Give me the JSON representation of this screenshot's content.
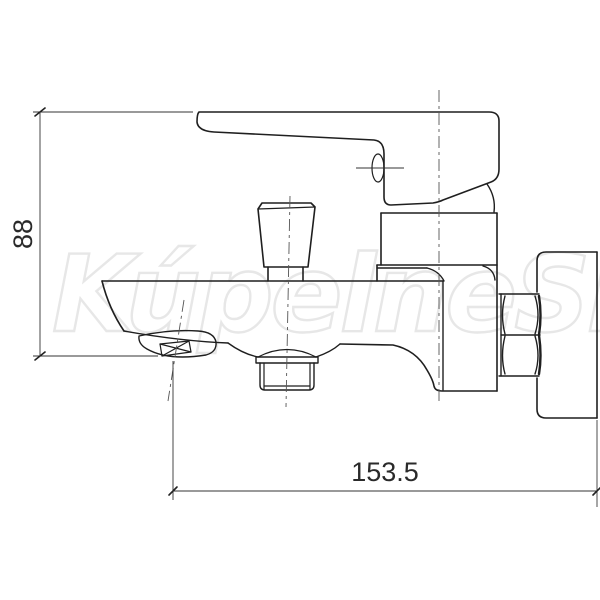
{
  "drawing": {
    "subject": "wall-mounted bath mixer tap, technical side view",
    "background": "#ffffff",
    "line_color": "#1f1f1f",
    "dimensions": {
      "height": "88",
      "width": "153.5"
    },
    "watermark": {
      "text": "KúpelneSK",
      "color": "#e7e7e7"
    }
  }
}
